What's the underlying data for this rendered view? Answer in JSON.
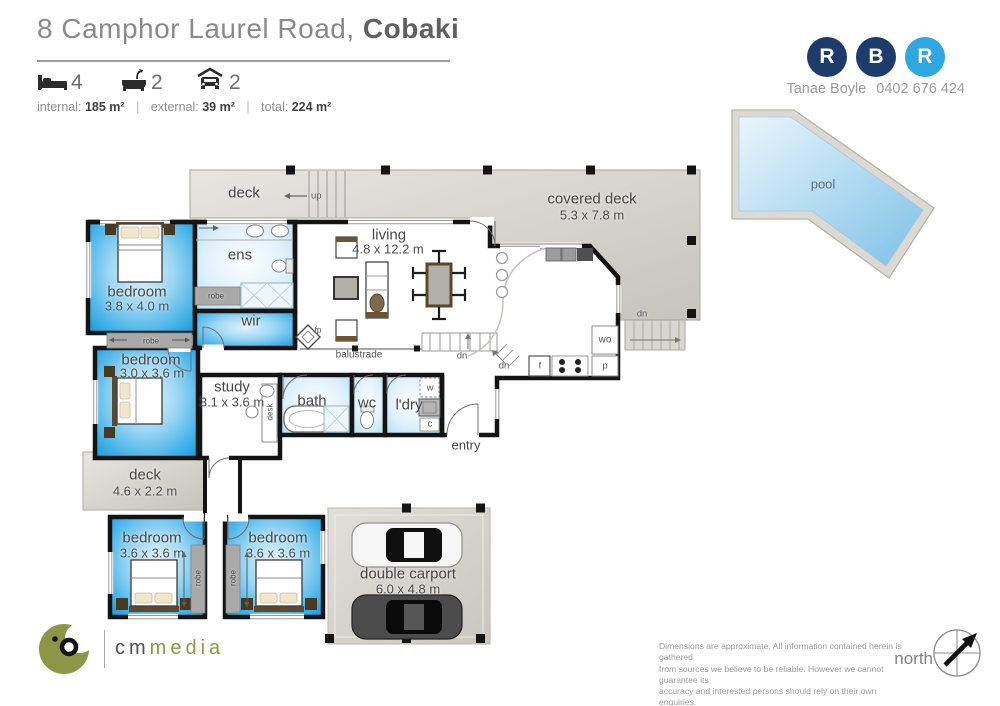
{
  "header": {
    "address": "8 Camphor Laurel Road,",
    "suburb": "Cobaki",
    "stats": {
      "beds": "4",
      "baths": "2",
      "cars": "2"
    },
    "areas": {
      "internal_label": "internal:",
      "internal": "185 m²",
      "external_label": "external:",
      "external": "39 m²",
      "total_label": "total:",
      "total": "224 m²",
      "sep": "|"
    }
  },
  "agency": {
    "letters": [
      "R",
      "B",
      "R"
    ],
    "agent": "Tanae Boyle",
    "phone": "0402 676 424",
    "navy": "#1e3c6b",
    "light_blue": "#2fa7e0"
  },
  "plan": {
    "labels": {
      "deck": "deck",
      "up": "up",
      "covered_deck": "covered deck",
      "covered_deck_size": "5.3 x 7.8 m",
      "living": "living",
      "living_size": "4.8 x 12.2 m",
      "ens": "ens",
      "robe": "robe",
      "wir": "wir",
      "bedroom": "bedroom",
      "bed1_size": "3.8 x 4.0 m",
      "bed2_size": "3.0 x 3.6 m",
      "bed34_size": "3.6 x 3.6 m",
      "study": "study",
      "study_size": "3.1 x 3.6 m",
      "desk": "desk",
      "bath": "bath",
      "wc": "wc",
      "ldry": "l'dry",
      "w": "w",
      "c": "c",
      "f": "f",
      "p": "p",
      "wo": "wo",
      "entry": "entry",
      "balustrade": "balustrade",
      "fp": "fp",
      "dn": "dn",
      "deck2_size": "4.6 x 2.2 m",
      "carport": "double carport",
      "carport_size": "6.0 x 4.8 m",
      "pool": "pool"
    },
    "room_blue": "#2ba6e0",
    "deck_gray": "#d5d2cb"
  },
  "footer": {
    "brand_cm": "cm",
    "brand_media": "media",
    "north": "north",
    "disclaimer": [
      "Dimensions are approximate.  All information contained herein is gathered",
      "from sources we believe to be reliable.  However we cannot guarantee its",
      "accuracy and interested persons should rely on their own enquiries."
    ]
  }
}
